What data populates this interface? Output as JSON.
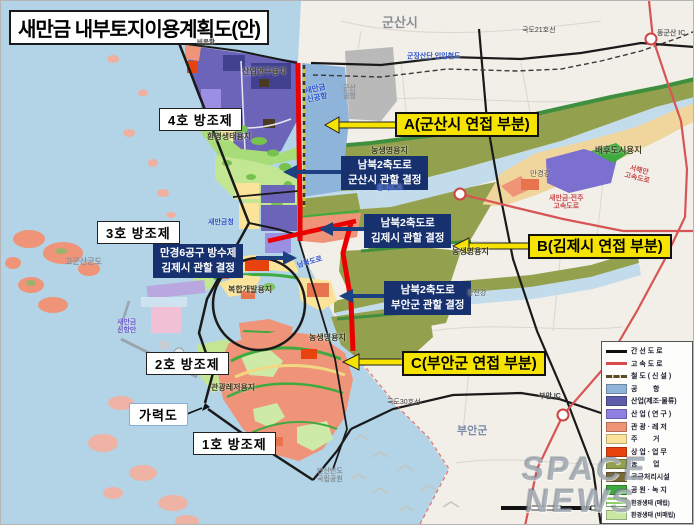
{
  "title": "새만금 내부토지이용계획도(안)",
  "seawalls": {
    "b4": "4호 방조제",
    "b3": "3호 방조제",
    "b2": "2호 방조제",
    "b1": "1호 방조제"
  },
  "garyeok_label": "가력도",
  "callouts": {
    "a": "A(군산시 연접 부분)",
    "b": "B(김제시 연접 부분)",
    "c": "C(부안군 연접 부분)"
  },
  "decisions": {
    "gunsan": {
      "line1": "남북2축도로",
      "line2": "군산시 관할 결정"
    },
    "gimje": {
      "line1": "남북2축도로",
      "line2": "김제시 관할 결정"
    },
    "buan": {
      "line1": "남북2축도로",
      "line2": "부안군 관할 결정"
    },
    "mangyeong": {
      "line1": "만경6공구 방수제",
      "line2": "김제시 관할 결정"
    }
  },
  "map_labels": {
    "gunsan_city": "군산시",
    "buan_gun": "부안군",
    "gogunsan_islands": "고군산군도",
    "byeonsan_line1": "변산반도",
    "byeonsan_line2": "국립공원",
    "bieung_port": "비응항",
    "industry_research": "산업연구용지",
    "env_eco": "환경생태용지",
    "gunsan_airport_line1": "군산",
    "gunsan_airport_line2": "공항",
    "smg_airport_line1": "새만금",
    "smg_airport_line2": "신공항",
    "smg_office": "새만금청",
    "new_port_line1": "새만금",
    "new_port_line2": "신항만",
    "complex_dev": "복합개발용지",
    "tourism": "관광레저용지",
    "agri_top": "농생명용지",
    "agri_mid": "농생명용지",
    "agri_bottom": "농생명용지",
    "baehu_city": "배후도시용지",
    "mangyeong_river": "만경강",
    "dongjin_river": "동진강",
    "national_road_21": "국도21호선",
    "national_road_30": "국도30호선",
    "donggunsan_ic": "동군산 IC",
    "buan_ic": "부안 IC",
    "gunjang_railway": "군장산단 인입철도",
    "seohaean_expwy_line1": "서해안",
    "seohaean_expwy_line2": "고속도로",
    "sj_expwy_line1": "새만금-전주",
    "sj_expwy_line2": "고속도로",
    "dongseo_road": "동서도로",
    "nambuk_road": "남북도로"
  },
  "legend": {
    "items": [
      {
        "label": "간 선 도 로",
        "type": "line",
        "color": "#111111"
      },
      {
        "label": "고 속 도 로",
        "type": "line",
        "color": "#d94b4b"
      },
      {
        "label": "철 도 ( 신 설 )",
        "type": "rail",
        "color": "#5a4a28"
      },
      {
        "label": "공        항",
        "type": "rect",
        "color": "#8fb4d9"
      },
      {
        "label": "산업(제조·물류)",
        "type": "rect",
        "color": "#5c5caa"
      },
      {
        "label": "산 업 ( 연 구 )",
        "type": "rect",
        "color": "#8f7fe0"
      },
      {
        "label": "관 광 · 레 저",
        "type": "rect",
        "color": "#ef9477"
      },
      {
        "label": "주        거",
        "type": "rect",
        "color": "#fbe49a"
      },
      {
        "label": "상 업 · 업 무",
        "type": "rect",
        "color": "#e8430f"
      },
      {
        "label": "농        업",
        "type": "rect",
        "color": "#93a050"
      },
      {
        "label": "공급처리시설",
        "type": "rect",
        "color": "#7c6a38"
      },
      {
        "label": "공 원 · 녹 지",
        "type": "rect",
        "color": "#3faa3f"
      },
      {
        "label": "환경생태 (매립)",
        "type": "stripes",
        "color": "#8fd06a"
      },
      {
        "label": "환경생태 (비매립)",
        "type": "rect",
        "color": "#c9e8a4"
      }
    ]
  },
  "watermark": {
    "line1": "SPACE",
    "line2": "NEWS"
  },
  "colors": {
    "sea": "#b2d4e6",
    "mainland": "#f1efe8",
    "boundary_red": "#ea0000",
    "expressway_red": "#d85555",
    "callout_yellow": "#f7e300",
    "decision_navy": "#17316f",
    "arrow_navy": "#1d4080",
    "agri_olive": "#93a04e",
    "industry_purple": "#6b64b8",
    "tourism_salmon": "#ef9478"
  }
}
